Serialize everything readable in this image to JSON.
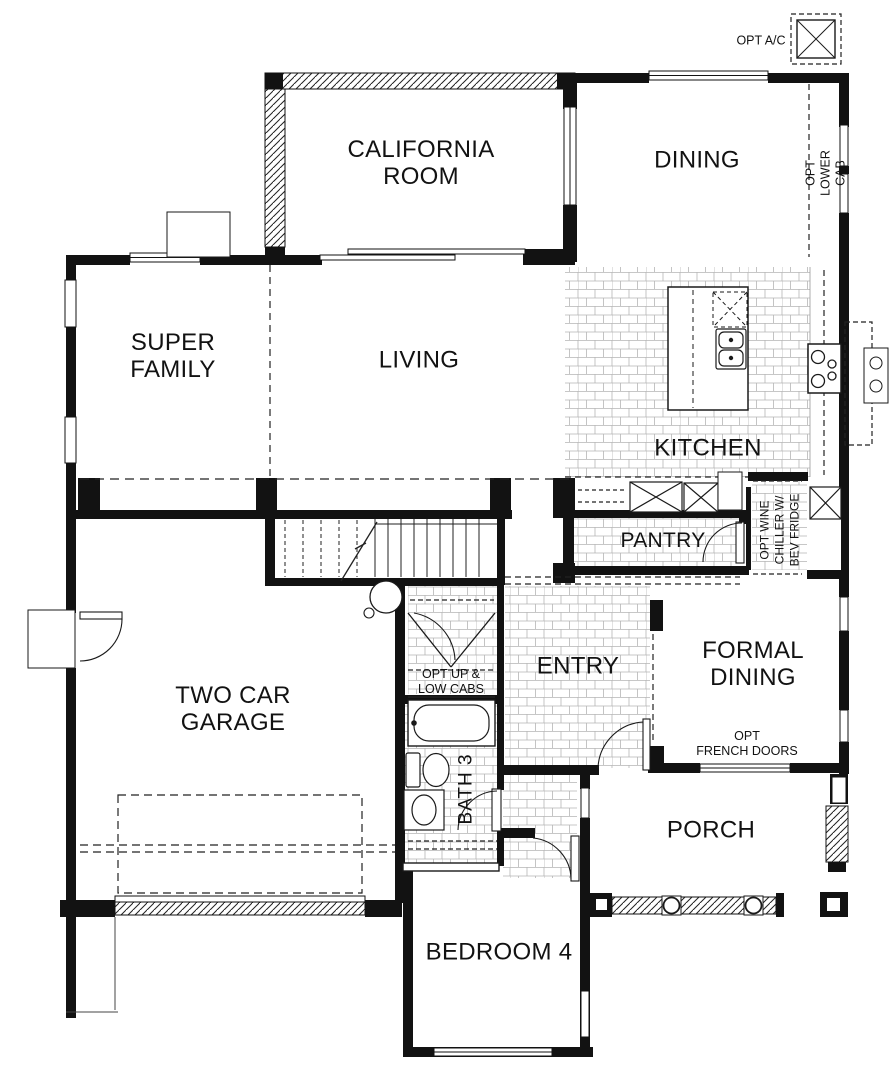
{
  "title": "First floor plan",
  "rooms": {
    "california_room": "CALIFORNIA\nROOM",
    "dining": "DINING",
    "super_family": "SUPER\nFAMILY",
    "living": "LIVING",
    "kitchen": "KITCHEN",
    "pantry": "PANTRY",
    "entry": "ENTRY",
    "formal_dining": "FORMAL\nDINING",
    "two_car_garage": "TWO CAR\nGARAGE",
    "bath3": "BATH 3",
    "porch": "PORCH",
    "bedroom4": "BEDROOM 4"
  },
  "annotations": {
    "opt_ac": "OPT A/C",
    "opt_lower_cab": "OPT LOWER CAB",
    "opt_wine_chiller": "OPT WINE\nCHILLER W/\nBEV FRIDGE",
    "opt_up_low_cabs": "OPT UP &\nLOW CABS",
    "opt_french_doors": "OPT\nFRENCH DOORS"
  },
  "colors": {
    "wall": "#121212",
    "tile_line": "#adadad",
    "background": "#ffffff"
  }
}
